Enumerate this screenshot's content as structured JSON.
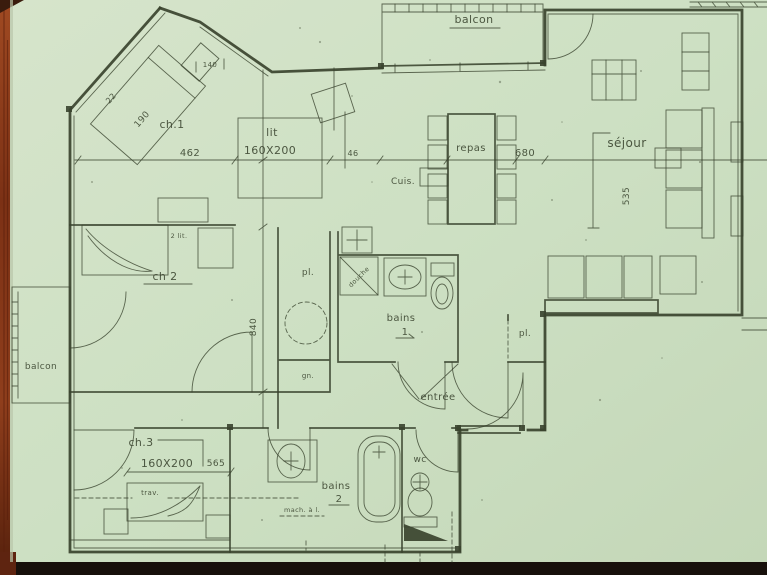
{
  "colors": {
    "paper": "#cfe0c5",
    "paper-edge": "#bfd3b2",
    "ink": "#39432e",
    "wood": "#94421d",
    "wood-dark": "#5e2410",
    "shadow-band": "#17100b"
  },
  "labels": {
    "balcon_top": "balcon",
    "balcon_left": "balcon",
    "ch1": "ch.1",
    "lit": "lit",
    "lit_size": "160X200",
    "bed1_len": "190",
    "bed1_w": "22",
    "dim_462": "462",
    "dim_140": "140",
    "dim_46": "46",
    "cuis": "Cuis.",
    "repas": "repas",
    "dim_680": "680",
    "sejour": "séjour",
    "dim_535": "535",
    "ch2": "ch 2",
    "ch2_note": "2 lit.",
    "pl_corridor": "pl.",
    "douche": "douche",
    "bains1": "bains",
    "bains1_no": "1",
    "dim_840": "840",
    "gn": "gn.",
    "entree": "entrée",
    "pl_entree": "pl.",
    "wc": "wc",
    "ch3": "ch.3",
    "ch3_dim": "160X200",
    "dim_565": "565",
    "trav": "trav.",
    "bains2": "bains",
    "bains2_no": "2",
    "mach": "mach. à l."
  }
}
